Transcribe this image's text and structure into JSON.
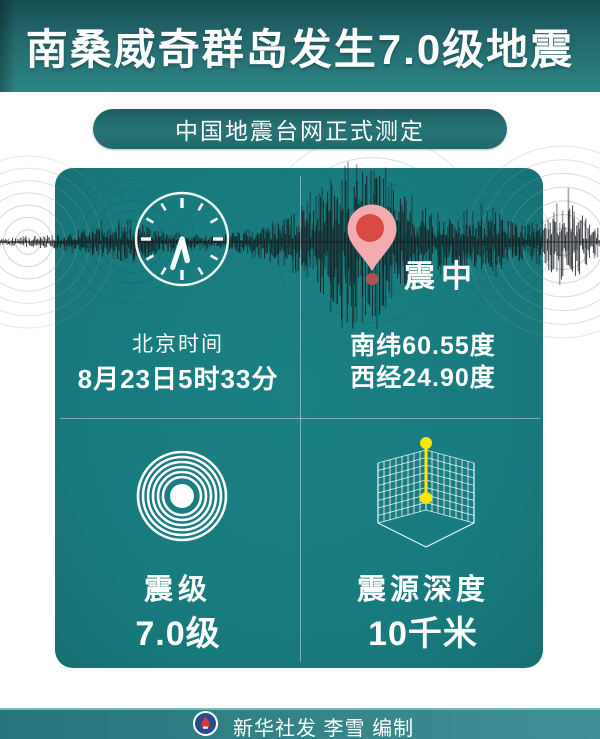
{
  "banner": {
    "title": "南桑威奇群岛发生7.0级地震"
  },
  "badge": {
    "label": "中国地震台网正式测定"
  },
  "panel": {
    "time": {
      "label": "北京时间",
      "value": "8月23日5时33分"
    },
    "epicenter": {
      "marker_label": "震中",
      "latitude": "南纬60.55度",
      "longitude": "西经24.90度"
    },
    "magnitude": {
      "label": "震级",
      "value": "7.0级"
    },
    "depth": {
      "label": "震源深度",
      "value": "10千米"
    }
  },
  "footer": {
    "credit": "新华社发 李雪 编制"
  },
  "icons": [
    "clock-icon",
    "map-pin-icon",
    "seismic-rings-icon",
    "depth-cube-icon",
    "seismogram-waveform",
    "xinhua-logo-icon"
  ],
  "colors": {
    "panel_teal": "#197c80",
    "banner_top": "#184f56",
    "banner_bottom": "#2e8587",
    "pin_pink": "#f4abae",
    "pin_red": "#d84a42",
    "depth_marker_yellow": "#ffe600",
    "waveform_black": "#15181c",
    "footer_teal": "#358489"
  }
}
